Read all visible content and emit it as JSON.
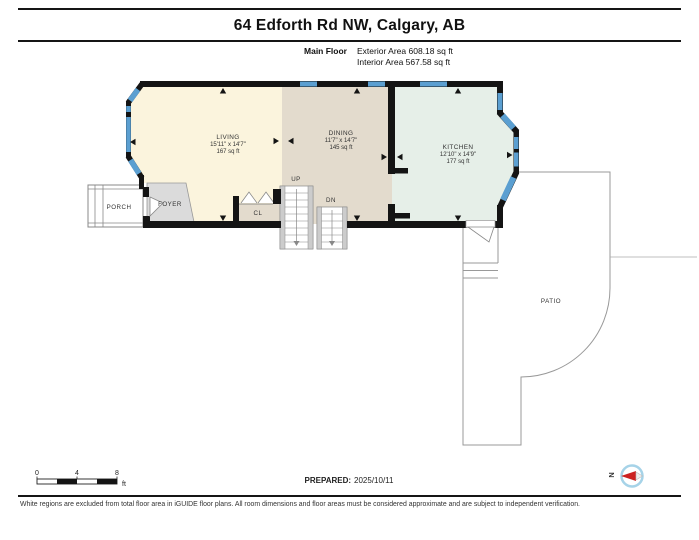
{
  "header": {
    "title": "64 Edforth Rd NW, Calgary, AB",
    "floor_label": "Main Floor",
    "exterior_area": "Exterior Area 608.18 sq ft",
    "interior_area": "Interior Area 567.58 sq ft"
  },
  "rooms": [
    {
      "name": "LIVING",
      "dimensions": "15'11\" x 14'7\"",
      "area": "167 sq ft"
    },
    {
      "name": "DINING",
      "dimensions": "11'7\" x 14'7\"",
      "area": "145 sq ft"
    },
    {
      "name": "KITCHEN",
      "dimensions": "12'10\" x 14'9\"",
      "area": "177 sq ft"
    }
  ],
  "labels": {
    "porch": "PORCH",
    "foyer": "FOYER",
    "closet": "CL",
    "up": "UP",
    "down": "DN",
    "patio": "PATIO",
    "north": "N"
  },
  "scale_bar": {
    "ticks": [
      "0",
      "4",
      "8"
    ],
    "unit": "ft"
  },
  "footer": {
    "prepared_label": "PREPARED:",
    "prepared_date": "2025/10/11",
    "disclaimer": "White regions are excluded from total floor area in iGUIDE floor plans. All room dimensions and floor areas must be considered approximate and are subject to independent verification."
  },
  "colors": {
    "wall": "#141414",
    "window": "#5b9fd1",
    "living_fill": "#fbf4dd",
    "dining_fill": "#e3dbcd",
    "kitchen_fill": "#e6efe8",
    "foyer_fill": "#dbdbdb",
    "compass_needle": "#cc2222",
    "compass_ring": "#a6d3e8"
  }
}
